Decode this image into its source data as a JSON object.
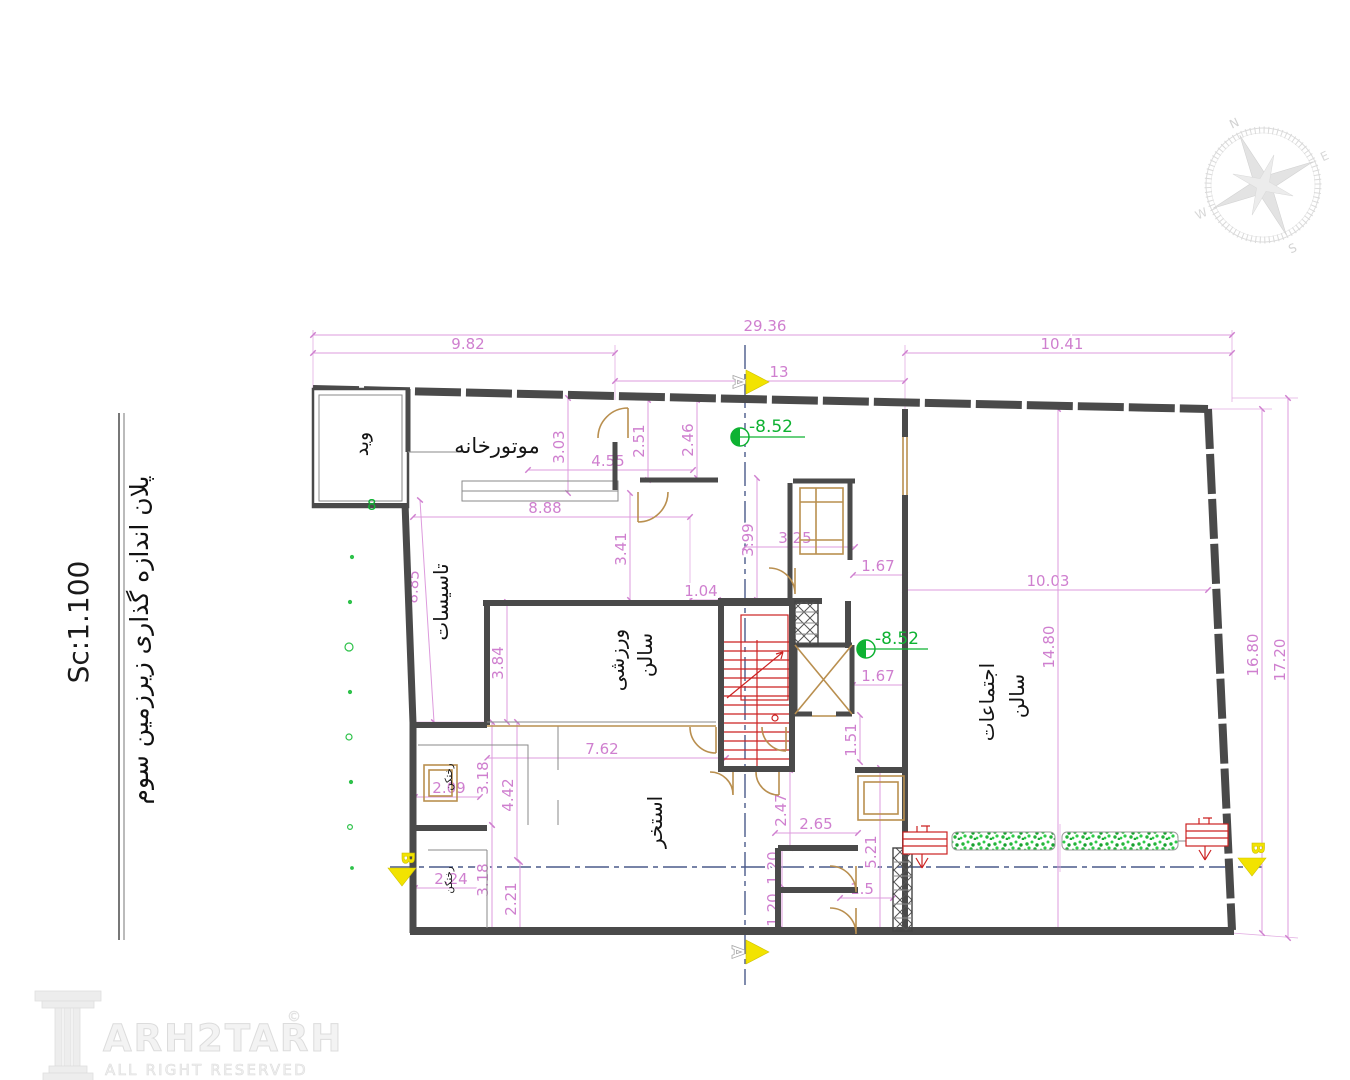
{
  "title_block": {
    "plan_title": "پلان اندازه گذاری زیرزمین سوم",
    "scale_label": "Sc:1.100"
  },
  "watermark": {
    "brand": "ARH2TARH",
    "copyright_symbol": "©",
    "tagline": "ALL RIGHT RESERVED"
  },
  "compass": {
    "north": "N",
    "east": "E",
    "south": "S",
    "west": "W"
  },
  "rooms": {
    "void": "وید",
    "boiler_room": "موتورخانه",
    "utilities": "تاسیسات",
    "gym_word1": "سالن",
    "gym_word2": "ورزشی",
    "pool": "استخر",
    "assembly_word1": "سالن",
    "assembly_word2": "اجتماعات",
    "locker_upper": "رختکن",
    "locker_lower": "رختکن"
  },
  "levels": {
    "elevation_top": "-8.52",
    "elevation_mid": "-8.52"
  },
  "section_markers": {
    "top": "A",
    "bottom": "A",
    "left": "B",
    "right": "B"
  },
  "grid_note": "8",
  "dims": {
    "overall_top": "29.36",
    "top_left": "9.82",
    "top_mid": "13",
    "top_right": "10.41",
    "right_outer": "17.20",
    "right_inner": "16.80",
    "d303": "3.03",
    "d251": "2.51",
    "d246": "2.46",
    "d455": "4.55",
    "d888": "8.88",
    "d341": "3.41",
    "d885": "8.85",
    "d399": "3.99",
    "d325": "3.25",
    "d104": "1.04",
    "d384": "3.84",
    "d762": "7.62",
    "d1003": "10.03",
    "d1480": "14.80",
    "d167a": "1.67",
    "d167b": "1.67",
    "d151": "1.51",
    "d247": "2.47",
    "d265": "2.65",
    "d521": "5.21",
    "d120a": "1.20",
    "d120b": "1.20",
    "d15": "1.5",
    "d209": "2.09",
    "d224": "2.24",
    "d318a": "3.18",
    "d318b": "3.18",
    "d442": "4.42",
    "d221": "2.21"
  }
}
